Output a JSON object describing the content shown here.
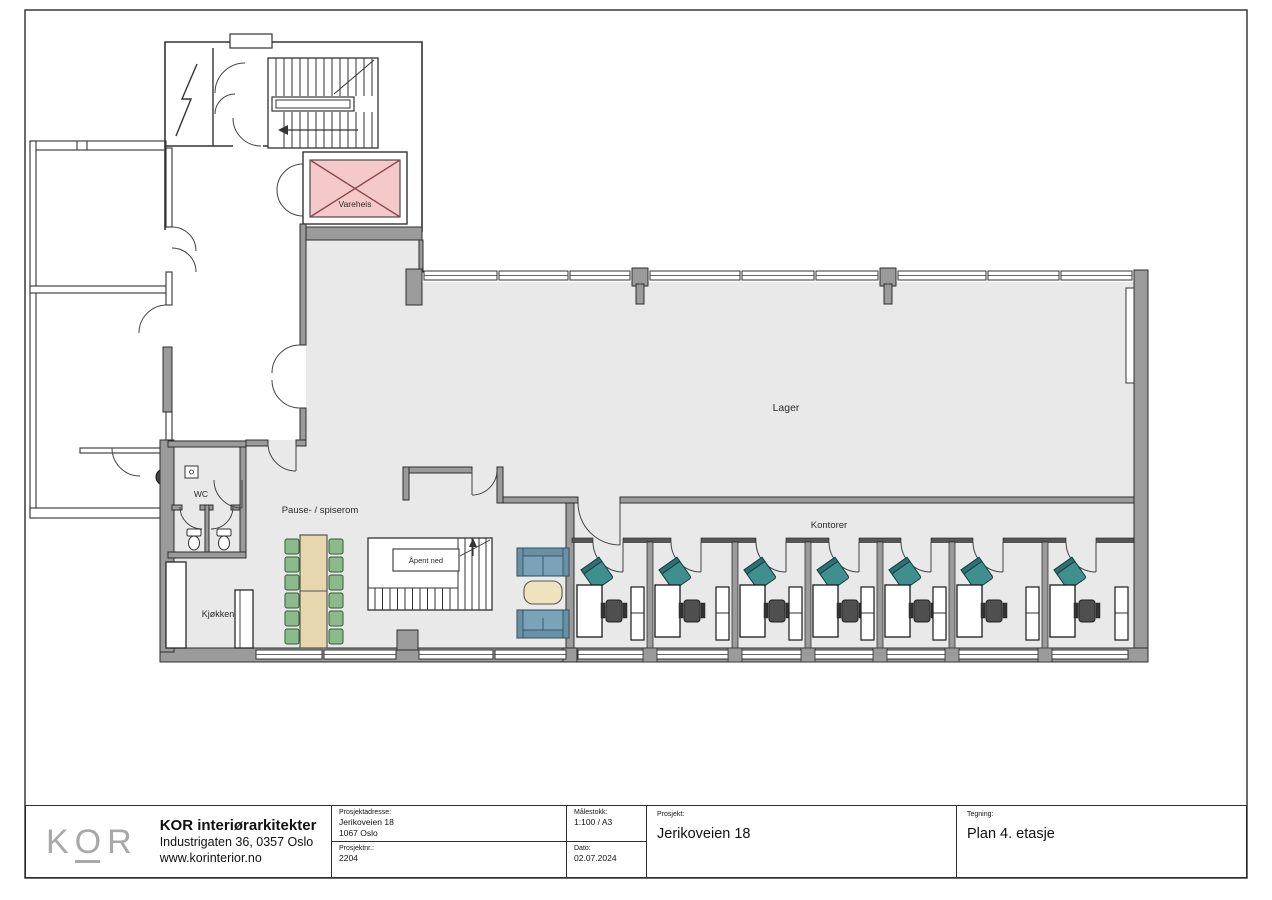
{
  "plan": {
    "labels": {
      "vareheis": "Vareheis",
      "lager": "Lager",
      "kontorer": "Kontorer",
      "pause": "Pause- / spiserom",
      "wc": "WC",
      "kjokken": "Kjøkken",
      "apent_ned": "Åpent ned"
    },
    "colors": {
      "floor": "#e9e9e9",
      "wall_gray": "#9b9b9b",
      "elevator_fill": "#f5c9c9",
      "elevator_cross": "#8a4a4a",
      "dining_chair_green": "#8cba8c",
      "sofa_blue": "#7ba3b8",
      "guest_chair_teal": "#3f8f8f",
      "table_tan": "#e6d7ae"
    }
  },
  "titleblock": {
    "logo": "KOR",
    "company": {
      "name": "KOR interiørarkitekter",
      "address": "Industrigaten 36, 0357 Oslo",
      "website": "www.korinterior.no"
    },
    "project_address": {
      "label": "Prosjektadresse:",
      "line1": "Jerikoveien 18",
      "line2": "1067 Oslo"
    },
    "project_number": {
      "label": "Prosjektnr.:",
      "value": "2204"
    },
    "scale": {
      "label": "Målestokk:",
      "value": "1:100 / A3"
    },
    "date": {
      "label": "Dato:",
      "value": "02.07.2024"
    },
    "project": {
      "label": "Prosjekt:",
      "value": "Jerikoveien 18"
    },
    "drawing": {
      "label": "Tegning:",
      "value": "Plan 4. etasje"
    }
  }
}
